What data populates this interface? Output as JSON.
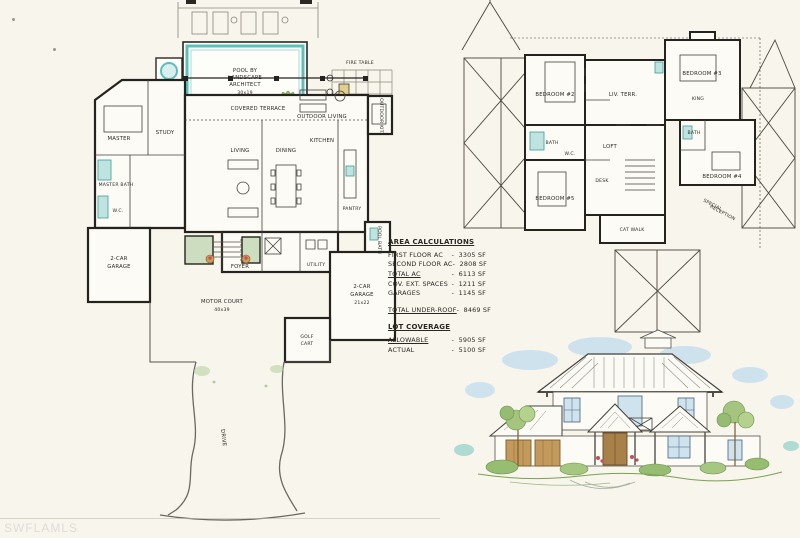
{
  "watermark": "SWFLAMLS",
  "colors": {
    "paper": "#f8f5ec",
    "ink": "#2b2823",
    "water_teal": "#5bc0bc",
    "landscape_green": "#8fbf5a",
    "porch_green": "#cdddc0",
    "sky_blue": "#b9d9f0",
    "wood_tan": "#c49a5c",
    "flower_red": "#c84a5e"
  },
  "area_calculations": {
    "title": "AREA CALCULATIONS",
    "rows": [
      {
        "label": "FIRST FLOOR AC",
        "value": "3305 SF"
      },
      {
        "label": "SECOND FLOOR AC",
        "value": "2808 SF"
      },
      {
        "label": "TOTAL AC",
        "value": "6113 SF"
      },
      {
        "label": "COV. EXT. SPACES",
        "value": "1211 SF"
      },
      {
        "label": "GARAGES",
        "value": "1145 SF"
      },
      {
        "label": "TOTAL UNDER-ROOF",
        "value": "8469 SF"
      }
    ],
    "lot_coverage_title": "LOT COVERAGE",
    "lot_rows": [
      {
        "label": "ALLOWABLE",
        "value": "5905 SF"
      },
      {
        "label": "ACTUAL",
        "value": "5100 SF"
      }
    ]
  },
  "first_floor": {
    "labels": {
      "spa": "SPA",
      "fire_table": "FIRE TABLE",
      "pool_1": "POOL BY",
      "pool_2": "LANDSCAPE",
      "pool_3": "ARCHITECT",
      "pool_dim": "30x19",
      "covered_terrace": "COVERED TERRACE",
      "outdoor_living": "OUTDOOR LIVING",
      "outdoor_kitchen": "OUTDOOR KIT.",
      "pool_bath": "POOL BATH",
      "master": "MASTER",
      "study": "STUDY",
      "master_bath": "MASTER BATH",
      "wc": "W.C.",
      "living": "LIVING",
      "dining": "DINING",
      "kitchen": "KITCHEN",
      "pantry": "PANTRY",
      "foyer": "FOYER",
      "utility": "UTILITY",
      "garage_left_1": "2-CAR",
      "garage_left_2": "GARAGE",
      "garage_right_1": "2-CAR",
      "garage_right_2": "GARAGE",
      "garage_right_dim": "21x22",
      "golf_1": "GOLF",
      "golf_2": "CART",
      "motor_court": "MOTOR COURT",
      "motor_court_dim": "40x39",
      "drive": "DRIVE"
    }
  },
  "second_floor": {
    "labels": {
      "bedroom2": "BEDROOM #2",
      "bedroom3": "BEDROOM #3",
      "bedroom4": "BEDROOM #4",
      "bedroom5": "BEDROOM #5",
      "king": "KING",
      "bath": "BATH",
      "bath2": "BATH",
      "wc": "W.C.",
      "liv_terr": "LIV. TERR.",
      "loft": "LOFT",
      "desk": "DESK",
      "cat_walk": "CAT WALK",
      "special_1": "SPECIAL",
      "special_2": "RECEPTION"
    }
  }
}
